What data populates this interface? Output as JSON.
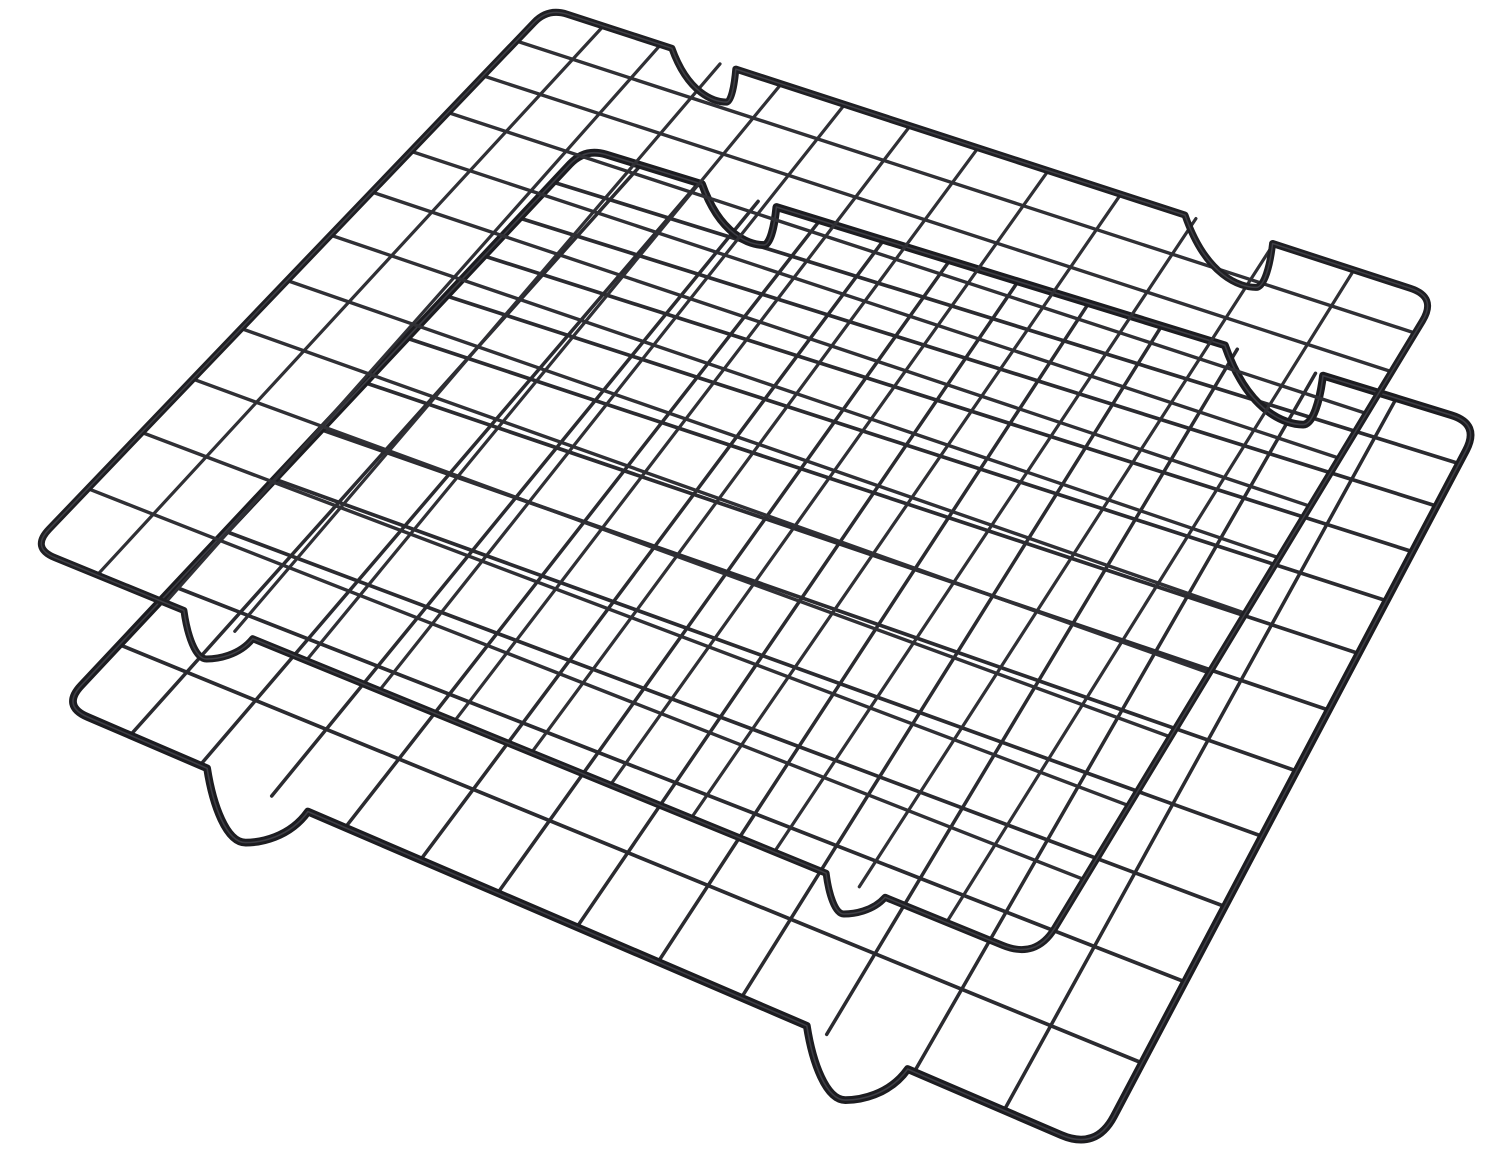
{
  "product": {
    "description": "Two black nonstick steel wire baking cooling racks, stacked overlapping diagonally on a plain white background",
    "item_count": 2,
    "background_color": "#ffffff"
  },
  "colors": {
    "background": "#ffffff",
    "wire": "#2e2e33",
    "border": "#1e1e22",
    "border_highlight": "#5a5a62"
  },
  "racks": [
    {
      "name": "rear-rack",
      "corners": {
        "n": [
          585,
          148
        ],
        "e": [
          1480,
          424
        ],
        "s": [
          1096,
          1150
        ],
        "w": [
          62,
          706
        ]
      },
      "grid": {
        "cols": 13,
        "rows": 12,
        "fan_u": [
          1.5,
          1.35
        ],
        "fan_v": [
          1.8,
          2.2
        ]
      },
      "wire": {
        "width": 3.5,
        "color": "#2b2b30"
      },
      "border": {
        "width": 7.8,
        "color": "#1c1c20",
        "highlight_width": 1.6,
        "corner_radius": {
          "n": 22,
          "e": 30,
          "s": 38,
          "w": 28
        }
      },
      "feet": {
        "ne": [
          {
            "t": 0.18,
            "d": 44
          },
          {
            "t": 0.78,
            "d": 58
          }
        ],
        "sw": [
          {
            "t": 0.24,
            "d": 62
          },
          {
            "t": 0.82,
            "d": 62
          }
        ]
      }
    },
    {
      "name": "front-rack",
      "corners": {
        "n": [
          548,
          8
        ],
        "e": [
          1437,
          297
        ],
        "s": [
          1036,
          959
        ],
        "w": [
          31,
          548
        ]
      },
      "grid": {
        "cols": 13,
        "rows": 12,
        "fan_u": [
          1.5,
          1.35
        ],
        "fan_v": [
          1.8,
          2.2
        ]
      },
      "wire": {
        "width": 3.2,
        "color": "#303035"
      },
      "border": {
        "width": 7.0,
        "color": "#1f1f23",
        "highlight_width": 1.5,
        "corner_radius": {
          "n": 20,
          "e": 28,
          "s": 36,
          "w": 26
        }
      },
      "feet": {
        "ne": [
          {
            "t": 0.182,
            "d": 38
          },
          {
            "t": 0.775,
            "d": 52
          }
        ],
        "sw": [
          {
            "t": 0.185,
            "d": 36
          },
          {
            "t": 0.82,
            "d": 42
          }
        ]
      }
    }
  ]
}
